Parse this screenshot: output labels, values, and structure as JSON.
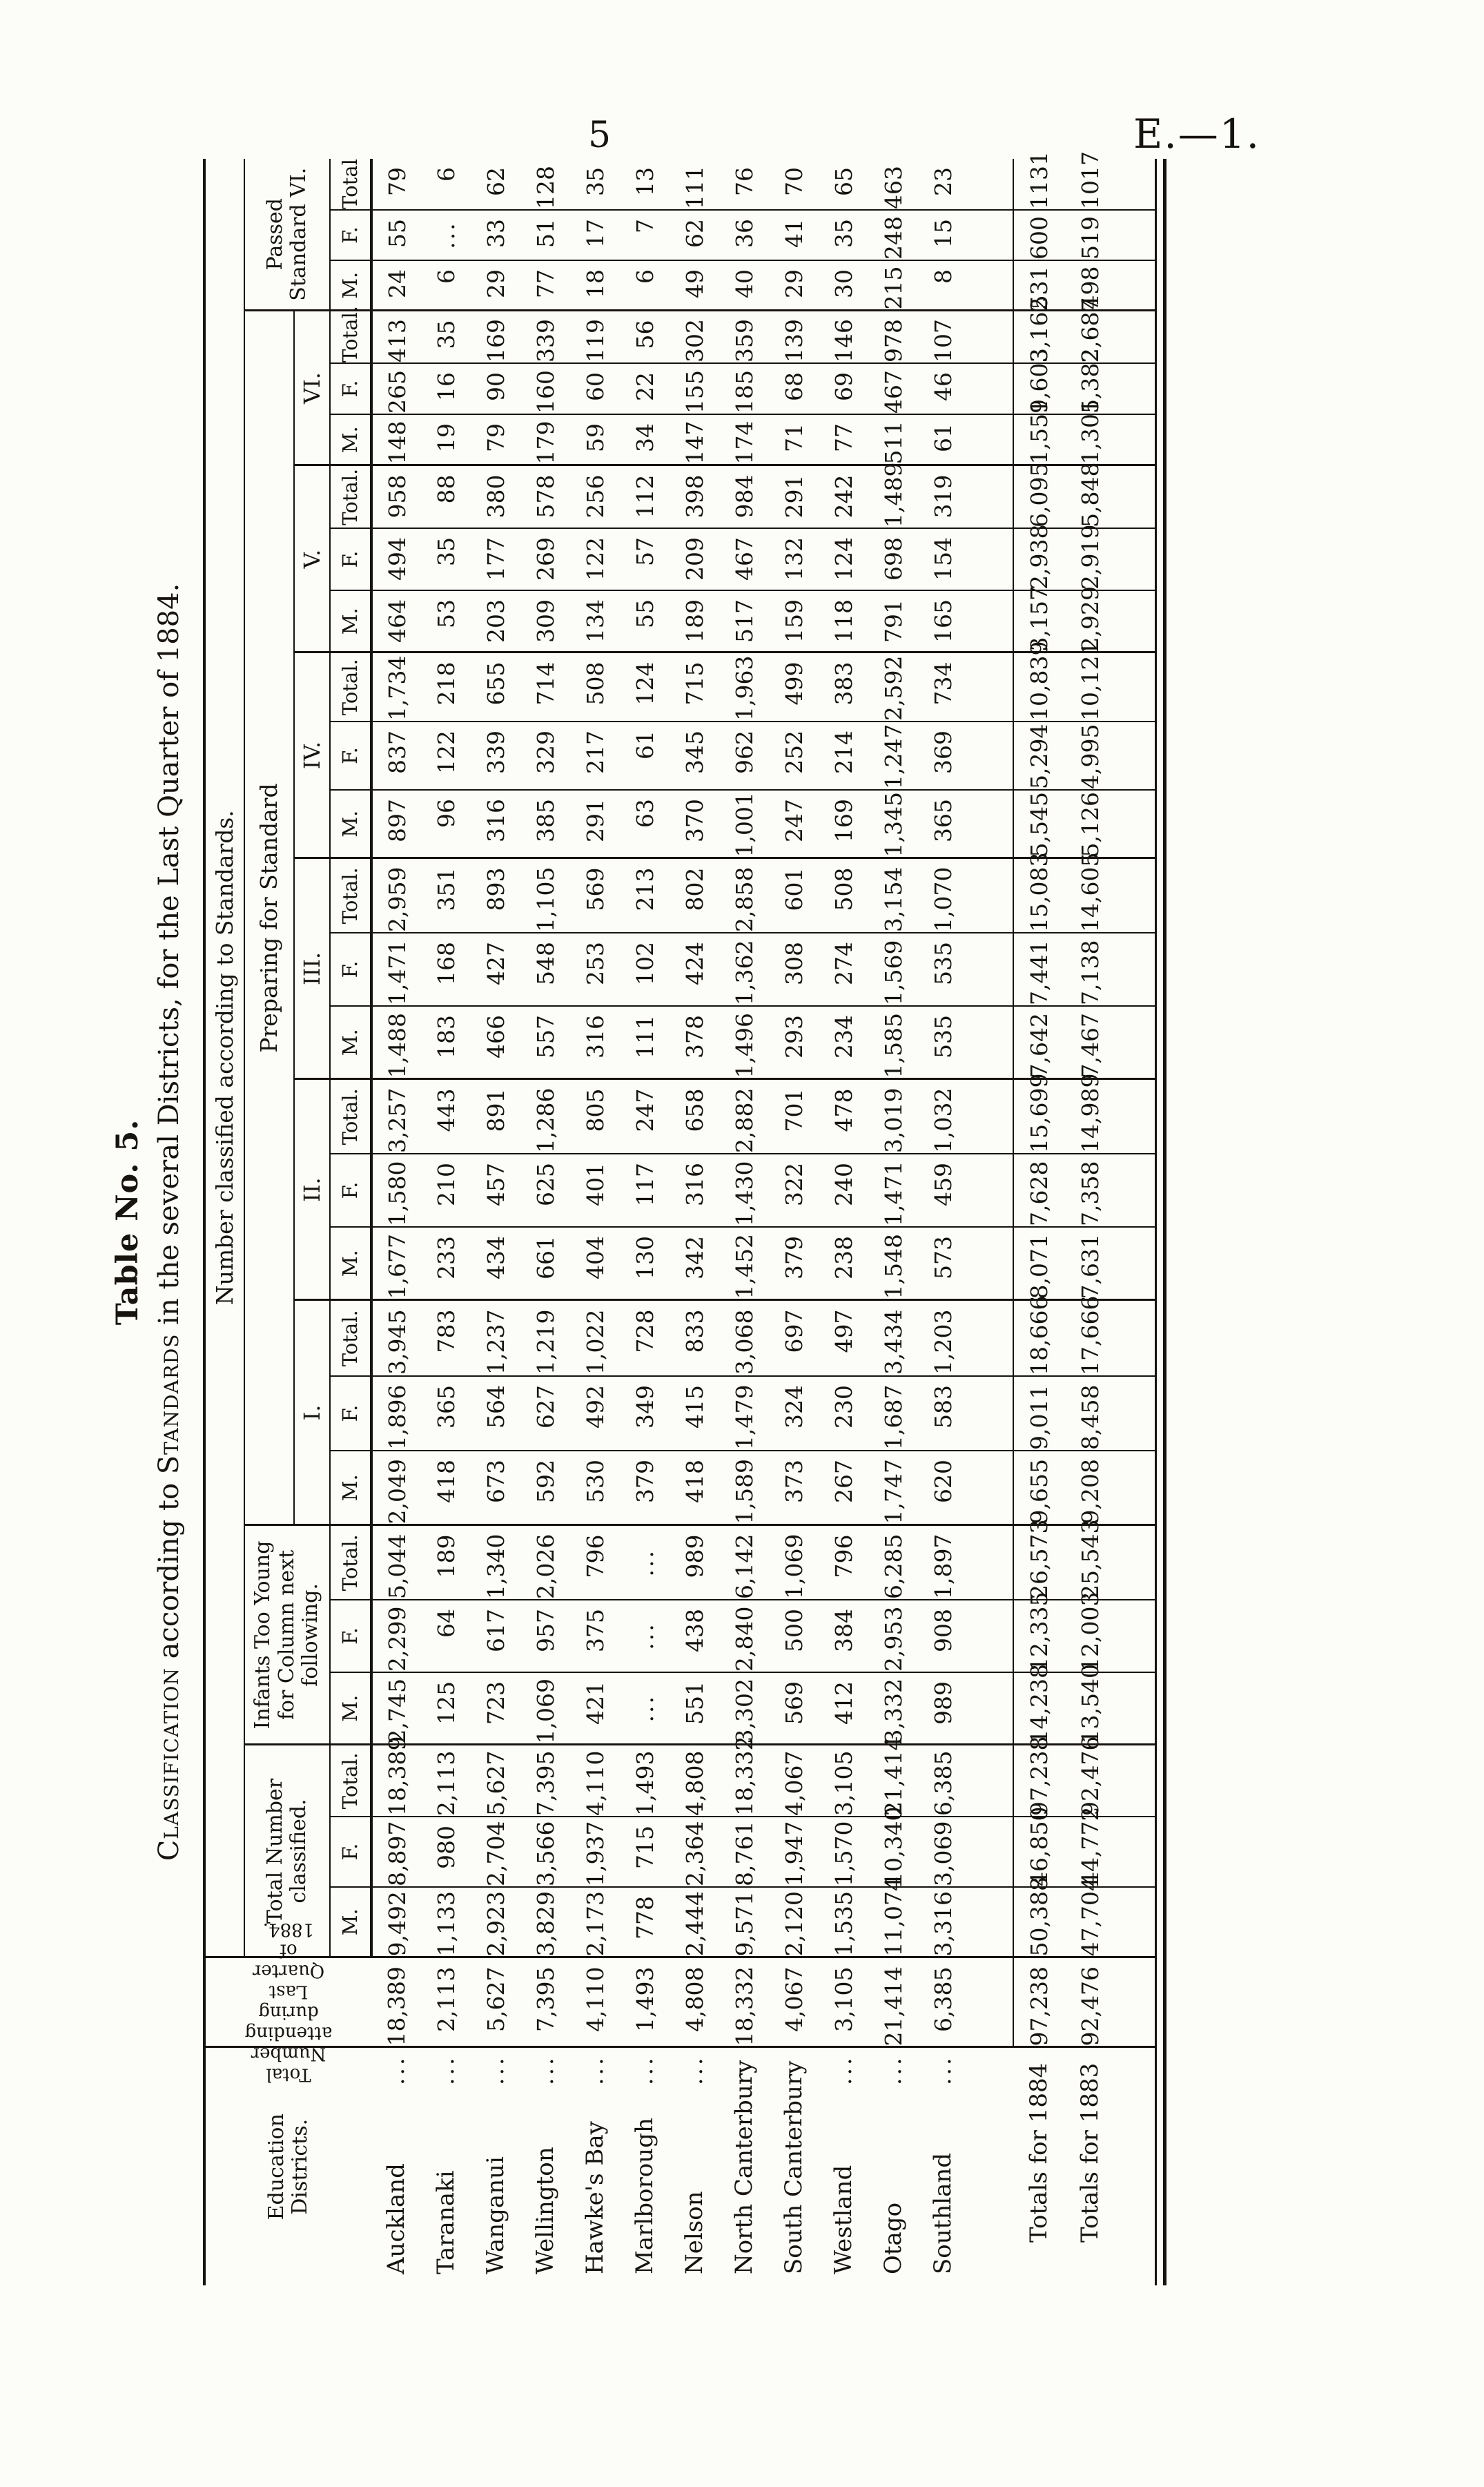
{
  "page": {
    "page_number": "5",
    "doc_ref": "E.—1."
  },
  "table": {
    "caption": "Table No. 5.",
    "title": {
      "lead_smallcaps": "Classification",
      "mid": " according to ",
      "mid_smallcaps": "Standards",
      "rest": " in the several Districts, for the Last Quarter of 1884."
    },
    "headers": {
      "districts": [
        "Education",
        "Districts."
      ],
      "attending": [
        "Total Number",
        "attending during",
        "Last Quarter of",
        "1884."
      ],
      "standards_span": "Number classified according to Standards.",
      "classified": "Total Number classified.",
      "infants": "Infants Too Young for Column next following.",
      "preparing": "Preparing for Standard",
      "passed": "Passed Standard VI.",
      "standard_groups": [
        "I.",
        "II.",
        "III.",
        "IV.",
        "V.",
        "VI."
      ],
      "sub": [
        "M.",
        "F.",
        "Total."
      ],
      "sub_passed": [
        "M.",
        "F.",
        "Total"
      ],
      "leader_dots": "..."
    },
    "rows": [
      {
        "name": "Auckland",
        "dots": true,
        "total": false,
        "values": [
          "18,389",
          "9,492",
          "8,897",
          "18,389",
          "2,745",
          "2,299",
          "5,044",
          "2,049",
          "1,896",
          "3,945",
          "1,677",
          "1,580",
          "3,257",
          "1,488",
          "1,471",
          "2,959",
          "897",
          "837",
          "1,734",
          "464",
          "494",
          "958",
          "148",
          "265",
          "413",
          "24",
          "55",
          "79"
        ]
      },
      {
        "name": "Taranaki",
        "dots": true,
        "total": false,
        "values": [
          "2,113",
          "1,133",
          "980",
          "2,113",
          "125",
          "64",
          "189",
          "418",
          "365",
          "783",
          "233",
          "210",
          "443",
          "183",
          "168",
          "351",
          "96",
          "122",
          "218",
          "53",
          "35",
          "88",
          "19",
          "16",
          "35",
          "6",
          "...",
          "6"
        ]
      },
      {
        "name": "Wanganui",
        "dots": true,
        "total": false,
        "values": [
          "5,627",
          "2,923",
          "2,704",
          "5,627",
          "723",
          "617",
          "1,340",
          "673",
          "564",
          "1,237",
          "434",
          "457",
          "891",
          "466",
          "427",
          "893",
          "316",
          "339",
          "655",
          "203",
          "177",
          "380",
          "79",
          "90",
          "169",
          "29",
          "33",
          "62"
        ]
      },
      {
        "name": "Wellington",
        "dots": true,
        "total": false,
        "values": [
          "7,395",
          "3,829",
          "3,566",
          "7,395",
          "1,069",
          "957",
          "2,026",
          "592",
          "627",
          "1,219",
          "661",
          "625",
          "1,286",
          "557",
          "548",
          "1,105",
          "385",
          "329",
          "714",
          "309",
          "269",
          "578",
          "179",
          "160",
          "339",
          "77",
          "51",
          "128"
        ]
      },
      {
        "name": "Hawke's Bay",
        "dots": true,
        "total": false,
        "values": [
          "4,110",
          "2,173",
          "1,937",
          "4,110",
          "421",
          "375",
          "796",
          "530",
          "492",
          "1,022",
          "404",
          "401",
          "805",
          "316",
          "253",
          "569",
          "291",
          "217",
          "508",
          "134",
          "122",
          "256",
          "59",
          "60",
          "119",
          "18",
          "17",
          "35"
        ]
      },
      {
        "name": "Marlborough",
        "dots": true,
        "total": false,
        "values": [
          "1,493",
          "778",
          "715",
          "1,493",
          "...",
          "...",
          "...",
          "379",
          "349",
          "728",
          "130",
          "117",
          "247",
          "111",
          "102",
          "213",
          "63",
          "61",
          "124",
          "55",
          "57",
          "112",
          "34",
          "22",
          "56",
          "6",
          "7",
          "13"
        ]
      },
      {
        "name": "Nelson",
        "dots": true,
        "total": false,
        "values": [
          "4,808",
          "2,444",
          "2,364",
          "4,808",
          "551",
          "438",
          "989",
          "418",
          "415",
          "833",
          "342",
          "316",
          "658",
          "378",
          "424",
          "802",
          "370",
          "345",
          "715",
          "189",
          "209",
          "398",
          "147",
          "155",
          "302",
          "49",
          "62",
          "111"
        ]
      },
      {
        "name": "North Canterbury",
        "dots": false,
        "total": false,
        "values": [
          "18,332",
          "9,571",
          "8,761",
          "18,332",
          "3,302",
          "2,840",
          "6,142",
          "1,589",
          "1,479",
          "3,068",
          "1,452",
          "1,430",
          "2,882",
          "1,496",
          "1,362",
          "2,858",
          "1,001",
          "962",
          "1,963",
          "517",
          "467",
          "984",
          "174",
          "185",
          "359",
          "40",
          "36",
          "76"
        ]
      },
      {
        "name": "South Canterbury",
        "dots": false,
        "total": false,
        "values": [
          "4,067",
          "2,120",
          "1,947",
          "4,067",
          "569",
          "500",
          "1,069",
          "373",
          "324",
          "697",
          "379",
          "322",
          "701",
          "293",
          "308",
          "601",
          "247",
          "252",
          "499",
          "159",
          "132",
          "291",
          "71",
          "68",
          "139",
          "29",
          "41",
          "70"
        ]
      },
      {
        "name": "Westland",
        "dots": true,
        "total": false,
        "values": [
          "3,105",
          "1,535",
          "1,570",
          "3,105",
          "412",
          "384",
          "796",
          "267",
          "230",
          "497",
          "238",
          "240",
          "478",
          "234",
          "274",
          "508",
          "169",
          "214",
          "383",
          "118",
          "124",
          "242",
          "77",
          "69",
          "146",
          "30",
          "35",
          "65"
        ]
      },
      {
        "name": "Otago",
        "dots": true,
        "total": false,
        "values": [
          "21,414",
          "11,074",
          "10,340",
          "21,414",
          "3,332",
          "2,953",
          "6,285",
          "1,747",
          "1,687",
          "3,434",
          "1,548",
          "1,471",
          "3,019",
          "1,585",
          "1,569",
          "3,154",
          "1,345",
          "1,247",
          "2,592",
          "791",
          "698",
          "1,489",
          "511",
          "467",
          "978",
          "215",
          "248",
          "463"
        ]
      },
      {
        "name": "Southland",
        "dots": true,
        "total": false,
        "values": [
          "6,385",
          "3,316",
          "3,069",
          "6,385",
          "989",
          "908",
          "1,897",
          "620",
          "583",
          "1,203",
          "573",
          "459",
          "1,032",
          "535",
          "535",
          "1,070",
          "365",
          "369",
          "734",
          "165",
          "154",
          "319",
          "61",
          "46",
          "107",
          "8",
          "15",
          "23"
        ]
      },
      {
        "name": "Totals for 1884",
        "dots": false,
        "total": true,
        "values": [
          "97,238",
          "50,388",
          "46,850",
          "97,238",
          "14,238",
          "12,335",
          "26,573",
          "9,655",
          "9,011",
          "18,666",
          "8,071",
          "7,628",
          "15,699",
          "7,642",
          "7,441",
          "15,083",
          "5,545",
          "5,294",
          "10,839",
          "3,157",
          "2,938",
          "6,095",
          "1,559",
          "1,603",
          "3,162",
          "531",
          "600",
          "1131"
        ]
      },
      {
        "name": "Totals for 1883",
        "dots": false,
        "total": true,
        "values": [
          "92,476",
          "47,704",
          "44,772",
          "92,476",
          "13,540",
          "12,003",
          "25,543",
          "9,208",
          "8,458",
          "17,666",
          "7,631",
          "7,358",
          "14,989",
          "7,467",
          "7,138",
          "14,605",
          "5,126",
          "4,995",
          "10,121",
          "2,929",
          "2,919",
          "5,848",
          "1,305",
          "1,382",
          "2,687",
          "498",
          "519",
          "1017"
        ]
      }
    ]
  }
}
